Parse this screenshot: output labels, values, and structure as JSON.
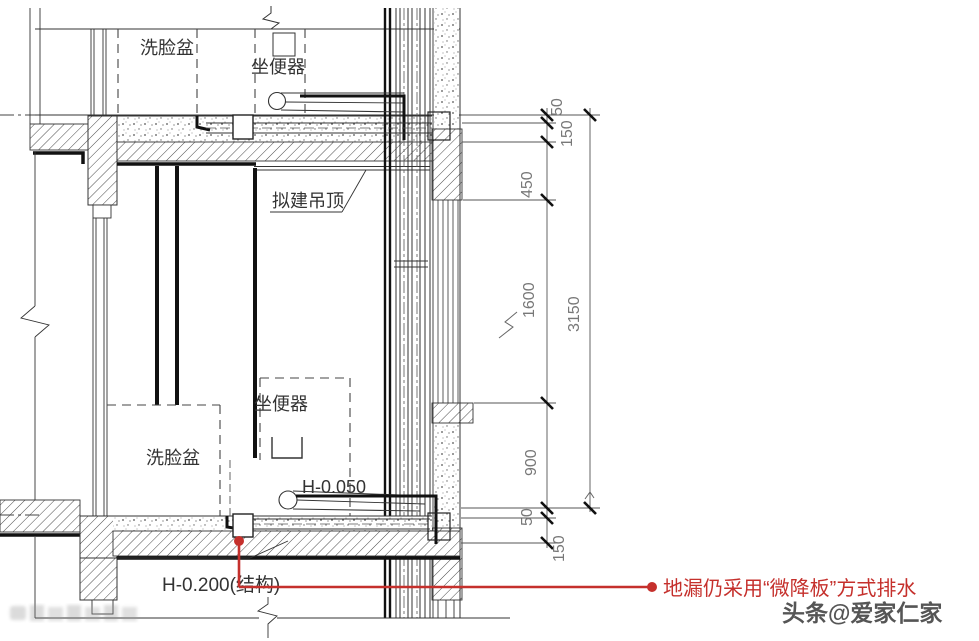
{
  "labels": {
    "upper_basin": "洗脸盆",
    "upper_toilet": "坐便器",
    "proposed_ceiling": "拟建吊顶",
    "lower_basin": "洗脸盆",
    "lower_toilet": "坐便器",
    "level_mid": "H-0.050",
    "level_floor": "H-0.200(结构)"
  },
  "dimensions": {
    "right_inner": [
      "50",
      "150",
      "450",
      "1600",
      "900",
      "50",
      "150"
    ],
    "overall": "3150"
  },
  "annotation": {
    "floor_drain": "地漏仍采用“微降板”方式排水"
  },
  "watermark": "头条@爱家仁家",
  "colors": {
    "annotation_red": "#c5302c",
    "linework": "#333333"
  }
}
